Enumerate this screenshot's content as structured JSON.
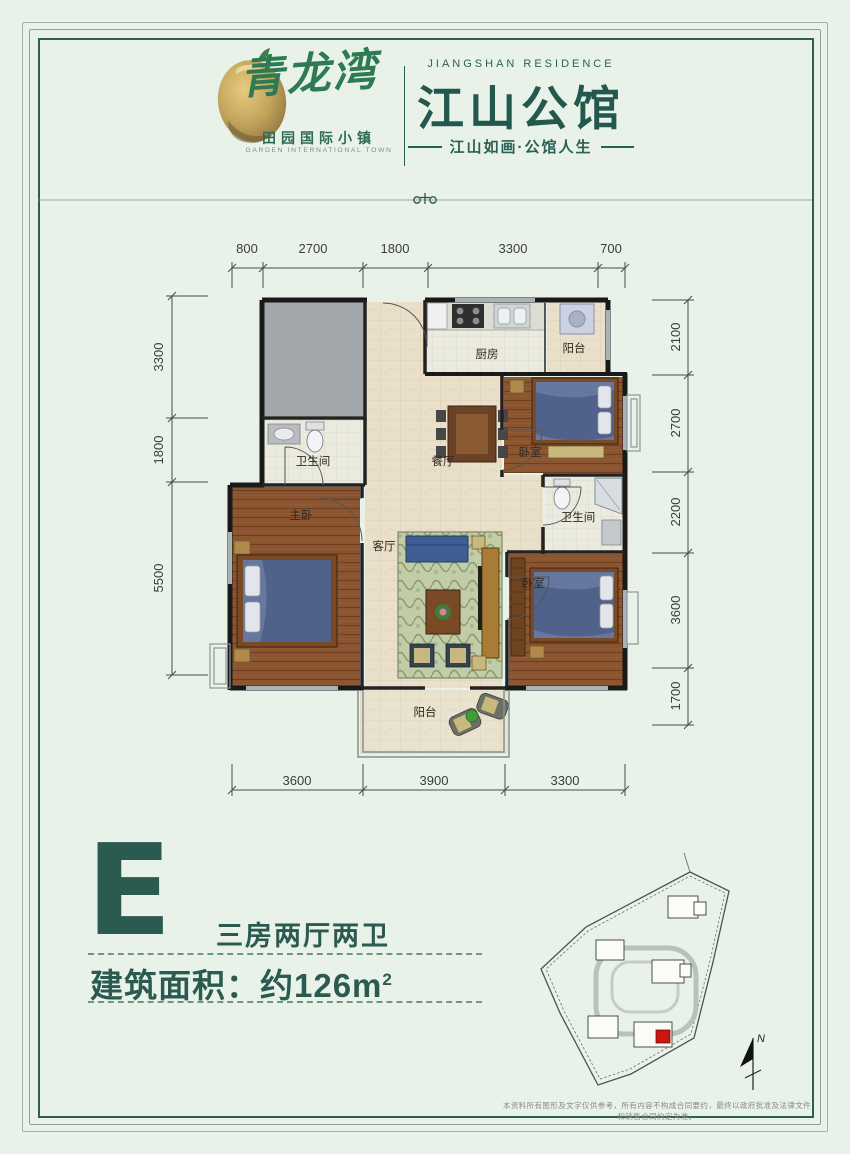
{
  "brand": {
    "logo_script": "青龙湾",
    "logo_sub": "田园国际小镇",
    "logo_sub_en": "GARDEN INTERNATIONAL TOWN",
    "project_en": "JIANGSHAN RESIDENCE",
    "project_name": "江山公馆",
    "tagline": "江山如画·公馆人生"
  },
  "floorplan": {
    "rooms": {
      "kitchen": "厨房",
      "balcony_top": "阳台",
      "bedroom_top": "卧室",
      "bath_right": "卫生间",
      "bedroom_bottom": "卧室",
      "bath_left": "卫生间",
      "master": "主卧",
      "dining": "餐厅",
      "living": "客厅",
      "balcony_bottom": "阳台"
    },
    "dims": {
      "top": [
        "800",
        "2700",
        "1800",
        "3300",
        "700"
      ],
      "left": [
        "3300",
        "1800",
        "5500"
      ],
      "right": [
        "2100",
        "2700",
        "2200",
        "3600",
        "1700"
      ],
      "bottom": [
        "3600",
        "3900",
        "3300"
      ]
    }
  },
  "unit": {
    "letter": "E",
    "layout": "三房两厅两卫",
    "area_label": "建筑面积：约126m",
    "area_sup": "2"
  },
  "sitemap": {
    "north": "N"
  },
  "disclaimer": "本资料所有图形及文字仅供参考，所有内容不构成合同要约，最终以政府批准及法律文件和销售合同约定为准。"
}
